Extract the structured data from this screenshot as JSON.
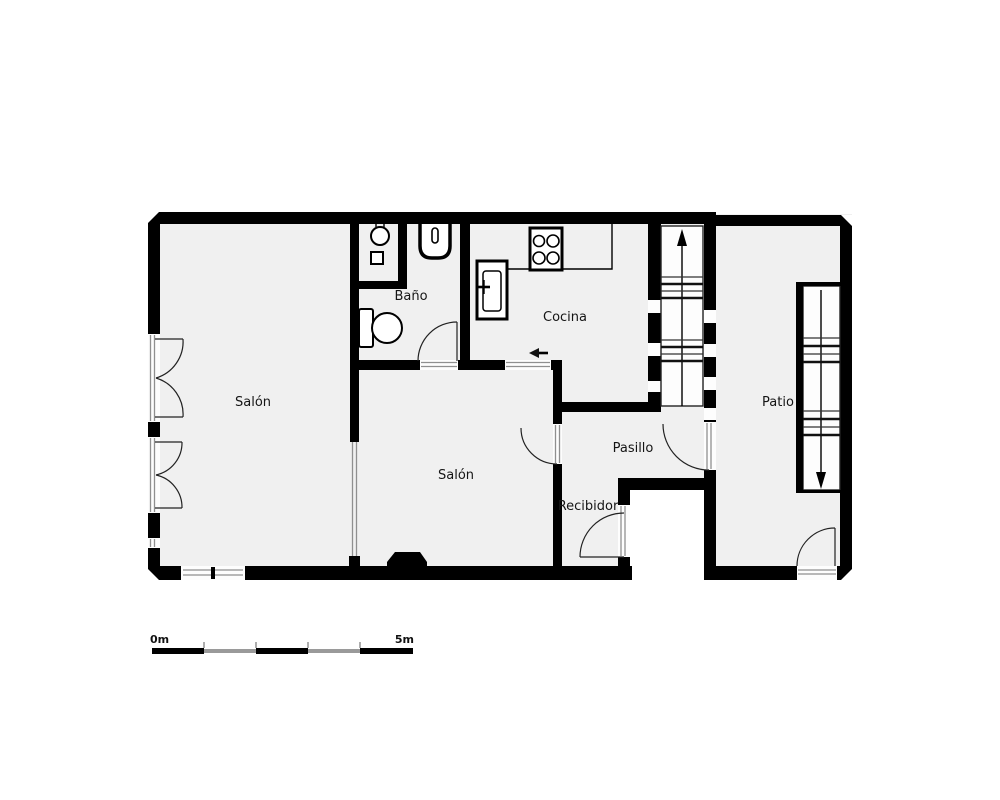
{
  "plan": {
    "rooms": {
      "salon_left": {
        "label": "Salón"
      },
      "bano": {
        "label": "Baño"
      },
      "cocina": {
        "label": "Cocina"
      },
      "salon_center": {
        "label": "Salón"
      },
      "pasillo": {
        "label": "Pasillo"
      },
      "recibidor": {
        "label": "Recibidor"
      },
      "patio": {
        "label": "Patio"
      }
    },
    "scale_bar": {
      "start_label": "0m",
      "end_label": "5m",
      "segments": 5
    },
    "fixtures": [
      "bathroom-sink-icon",
      "bidet-square-icon",
      "washbasin-icon",
      "toilet-icon",
      "stove-icon",
      "kitchen-sink-icon",
      "kitchen-counter",
      "stairs-up-icon",
      "stairs-down-icon",
      "entry-direction-arrow",
      "french-door-icon",
      "window-icon",
      "door-swing-icon",
      "glass-partition",
      "fireplace-icon"
    ]
  },
  "colors": {
    "wall": "#000000",
    "floor": "#f0f0f0",
    "background": "#ffffff",
    "scale_gray": "#9a9a9a"
  }
}
